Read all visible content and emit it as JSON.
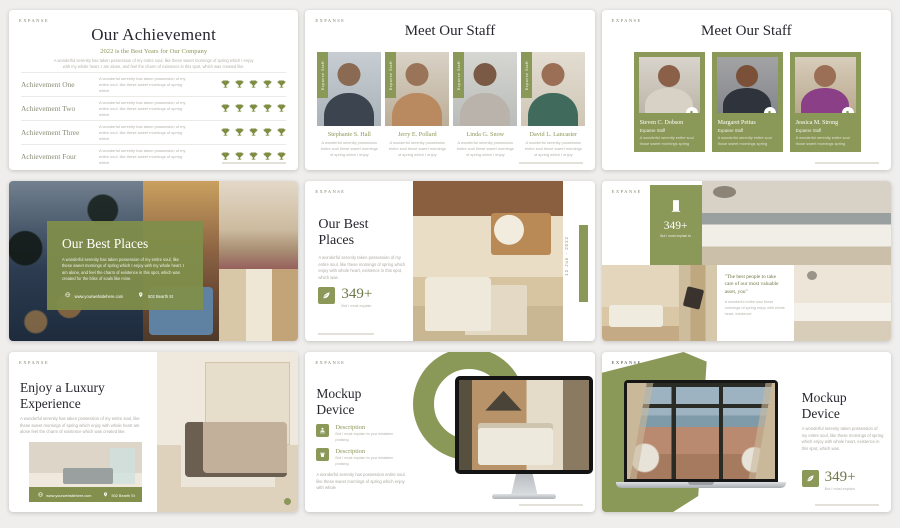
{
  "page": {
    "background": "#efeeec",
    "accent": "#8a9858",
    "accent_dark": "#6d7847"
  },
  "brand": "EXPANSE",
  "s1": {
    "title": "Our Achievement",
    "subtitle": "2022 is the Best Years for Our Company",
    "intro": "A wonderful serenity has taken possession of my entire soul, like these sweet mornings of spring which I enjoy with my whole heart. I am alone, and feel the charm of existence in this spot, which was created like.",
    "rows": [
      {
        "label": "Achievement One",
        "desc": "A wonderful serenity has taken possession of my entire soul, like these sweet mornings of spring which"
      },
      {
        "label": "Achievement Two",
        "desc": "A wonderful serenity has taken possession of my entire soul, like these sweet mornings of spring which"
      },
      {
        "label": "Achievement Three",
        "desc": "A wonderful serenity has taken possession of my entire soul, like these sweet mornings of spring which"
      },
      {
        "label": "Achievement Four",
        "desc": "A wonderful serenity has taken possession of my entire soul, like these sweet mornings of spring which"
      }
    ]
  },
  "s2": {
    "title": "Meet Our Staff",
    "ribbon": "Expanse Staff",
    "members": [
      {
        "name": "Stephanie S. Hall",
        "desc": "A wonderful serenity possession entire soul these sweet mornings of spring which I enjoy"
      },
      {
        "name": "Jerry E. Pollard",
        "desc": "A wonderful serenity possession entire soul these sweet mornings of spring which I enjoy"
      },
      {
        "name": "Linda G. Snow",
        "desc": "A wonderful serenity possession entire soul these sweet mornings of spring which I enjoy"
      },
      {
        "name": "David L. Lancaster",
        "desc": "A wonderful serenity possession entire soul these sweet mornings of spring which I enjoy"
      }
    ]
  },
  "s3": {
    "title": "Meet Our Staff",
    "members": [
      {
        "name": "Steven C. Dobson",
        "role": "Expanse Staff",
        "desc": "A wonderful serenity entire soul those sweet mornings spring"
      },
      {
        "name": "Margaret Pettus",
        "role": "Expanse Staff",
        "desc": "A wonderful serenity entire soul those sweet mornings spring"
      },
      {
        "name": "Jessica M. Strong",
        "role": "Expanse Staff",
        "desc": "A wonderful serenity entire soul those sweet mornings spring"
      }
    ]
  },
  "s4": {
    "title": "Our Best Places",
    "body": "A wonderful serenity has taken possession of my entire soul, like these sweet mornings of spring which I enjoy with my whole heart. I am alone, and feel the charm of existence in this spot, which was created for the bliss of souls like mine.",
    "website": "www.yourwebsitehere.com",
    "address": "502 Bearth St"
  },
  "s5": {
    "title": "Our Best Places",
    "body": "A wonderful serenity taken possession of my entire soul, like these mornings of spring which enjoy with whole heart, existence in this spot, which was.",
    "stat": "349+",
    "stat_caption": "But I must explain",
    "date": "12 Jun - 2022"
  },
  "s6": {
    "stat": "349+",
    "stat_caption": "But I must explain to",
    "quote": "\"The best people to take care of our most valuable asset, you\"",
    "quote_body": "A wonderful entire soul these mornings of spring enjoy with whole heart, existence"
  },
  "s7": {
    "title": "Enjoy a Luxury Experience",
    "body": "A wonderful serenity has taken possession of my entire soul, like these sweet mornings of spring which enjoy with whole heart am alone feel the charm of existence which was created like.",
    "website": "www.yourwebsitehere.com",
    "address": "502 Bearth St"
  },
  "s8": {
    "title": "Mockup Device",
    "items": [
      {
        "heading": "Description",
        "text": "But I must explain to you mistaken praising"
      },
      {
        "heading": "Description",
        "text": "But I must explain to you mistaken praising"
      }
    ],
    "body": "A wonderful serenity has possession entire soul, like these sweet mornings of spring which enjoy with whole"
  },
  "s9": {
    "title": "Mockup Device",
    "body": "A wonderful serenity taken possession of my entire soul, like these mornings of spring which enjoy with whole heart, existence in this spot, which was.",
    "stat": "349+",
    "stat_caption": "But I must explain"
  }
}
